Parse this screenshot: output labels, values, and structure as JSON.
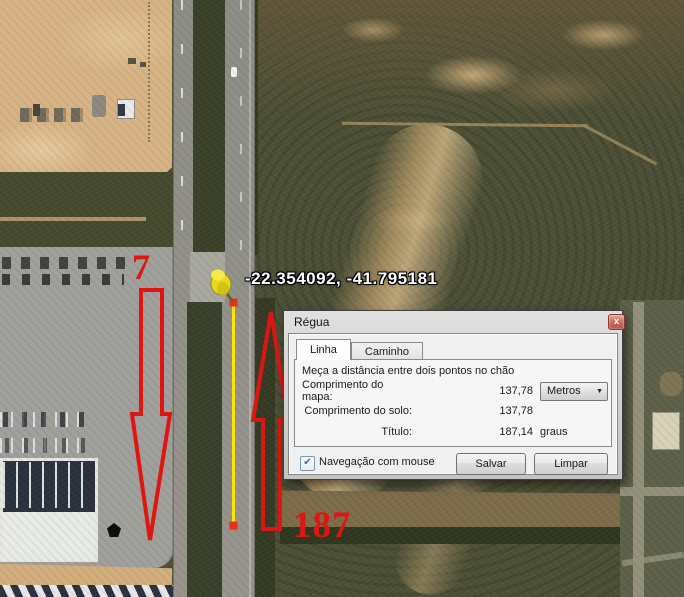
{
  "map": {
    "coordinates_label": "-22.354092, -41.795181",
    "annotation_top": "7",
    "annotation_bottom": "187",
    "colors": {
      "annotation_red": "#dd1612",
      "measure_line_yellow": "#ffe600",
      "endpoint_red": "#e8301c",
      "pushpin_yellow": "#eedd20"
    }
  },
  "icons": {
    "close": "x",
    "dropdown_arrow": "▼",
    "checkbox_check": "✔"
  },
  "dialog": {
    "title": "Régua",
    "tabs": [
      {
        "label": "Linha",
        "active": true
      },
      {
        "label": "Caminho",
        "active": false
      }
    ],
    "description": "Meça a distância entre dois pontos no chão",
    "fields": [
      {
        "label": "Comprimento do mapa:",
        "value": "137,78",
        "unit_dropdown": "Metros"
      },
      {
        "label": "Comprimento do solo:",
        "value": "137,78",
        "unit": ""
      },
      {
        "label": "Título:",
        "value": "187,14",
        "unit": "graus"
      }
    ],
    "checkbox": {
      "label": "Navegação com mouse",
      "checked": true
    },
    "buttons": [
      {
        "label": "Salvar"
      },
      {
        "label": "Limpar"
      }
    ]
  }
}
